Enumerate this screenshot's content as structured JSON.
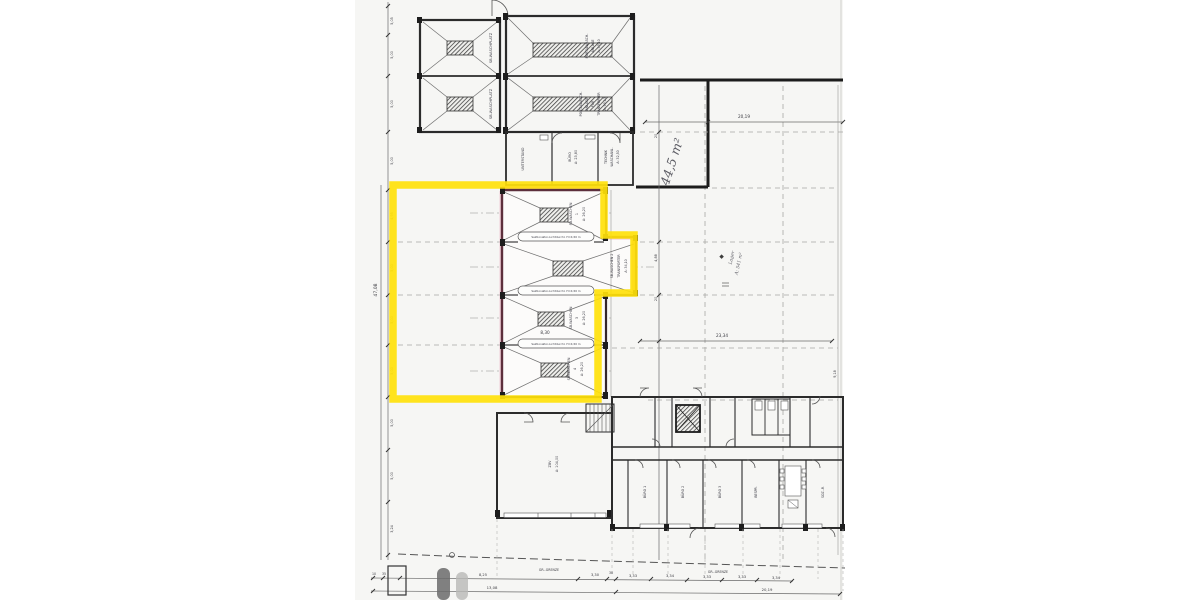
{
  "plan": {
    "highlight_color": "#ffe10a",
    "paper_color": "#f6f6f4",
    "buildings": {
      "waschplatz": {
        "bay_label": "SB-WASCHPLATZ"
      },
      "portal": {
        "bay1": [
          "PORTALWASCH-",
          "ANLAGE",
          "A: 59,10"
        ],
        "bay2": [
          "PORTALWASCH-",
          "ANLAGE",
          "FÜR",
          "TRANSPORTER",
          "A: 59,10"
        ]
      },
      "service": {
        "unterstand": "UNTERSTAND",
        "buero": [
          "BÜRO",
          "A: 23,80"
        ],
        "technik": [
          "TECHNIK",
          "WASCHANL.",
          "A: 32,50"
        ]
      },
      "hall": {
        "bay1": [
          "SB-WASCHEN",
          "1",
          "A: 26,20"
        ],
        "bay2": [
          "SB-WASCHEN 2",
          "TRANSPORTER",
          "A: 34,10"
        ],
        "bay3": [
          "SB-WASCHEN",
          "3",
          "A: 26,20"
        ],
        "bay4": [
          "SB-WASCHEN",
          "4",
          "A: 26,20"
        ],
        "gate_note": "Sektionaltor-Lichtdurchl. H=4,50 m",
        "width_dim": "8,30"
      },
      "zbv": [
        "ZBV",
        "A: 104,00"
      ],
      "offices": [
        "BÜRO 1",
        "BÜRO 2",
        "BÜRO 3",
        "BESPR.",
        "SOZ.-R."
      ]
    },
    "handwritten": {
      "area1": "44,5 m²",
      "area2_line1": "Lager",
      "area2_line2": "A: 541 m²"
    },
    "dimensions": {
      "top": "20,19",
      "middle": "23,34",
      "right_col": [
        "20",
        "4,88",
        "20"
      ],
      "far_right": "9,18",
      "left_overall": "47,08",
      "left_ticks": [
        "5,05",
        "5,00",
        "5,00",
        "5,00",
        "4,95",
        "5,00",
        "5,00",
        "5,00",
        "5,00",
        "5,00",
        "3,24"
      ],
      "bottom_row1": [
        "10",
        "35",
        "8,25",
        "3,30",
        "30",
        "3,33",
        "3,34",
        "3,33",
        "3,33",
        "3,34"
      ],
      "bottom_row2": [
        "13,08",
        "20,19"
      ],
      "boundary_label": "GR.-GRENZE"
    }
  }
}
